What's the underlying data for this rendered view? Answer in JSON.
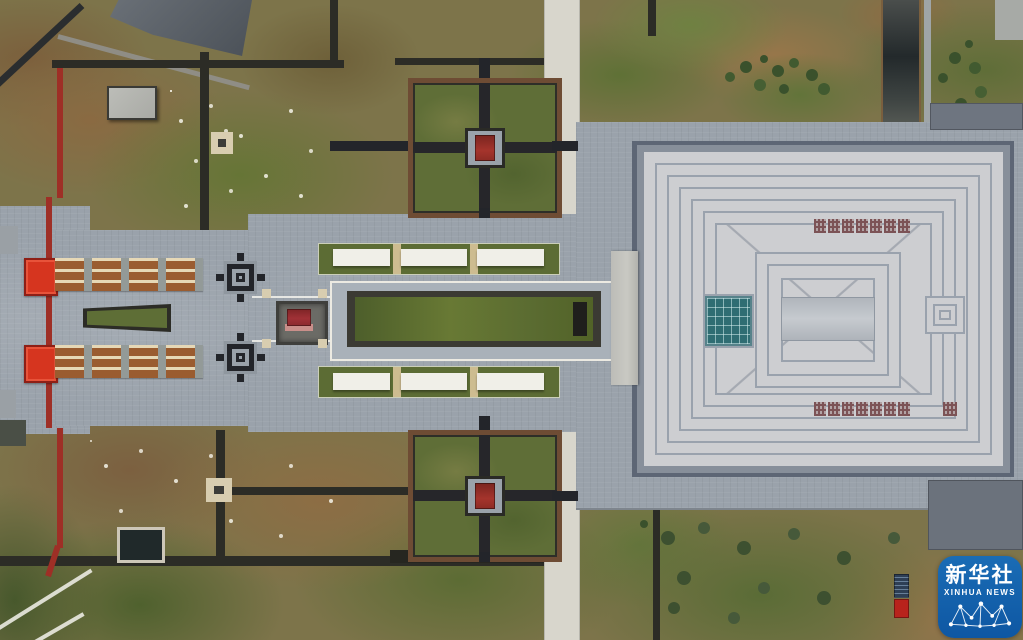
{
  "scene": {
    "type": "aerial-photograph",
    "subject": "Top-down drone view of a memorial complex: red entrance gates and stepped ramps on the west axis, a sunken lawn and monument, two cross-shaped courtyard gardens with red pavilions, and a large square grand hall with concentric roof pattern on the east"
  },
  "watermark": {
    "agency_cn": "新华社",
    "agency_en": "XINHUA NEWS",
    "badge_color": "#1365af"
  },
  "palette": {
    "plaza_gray": "#9aa2ab",
    "roof_light": "#cdced1",
    "roof_line": "#9aa2ad",
    "lawn_green": "#5d6d35",
    "terrain_brown": "#8f6f46",
    "gate_red": "#d6351f",
    "skylight_teal": "#2f6d73",
    "path_dark": "#2c2c26",
    "canopy_white": "#f0efe8",
    "wood_ramp": "#9a5c30"
  }
}
